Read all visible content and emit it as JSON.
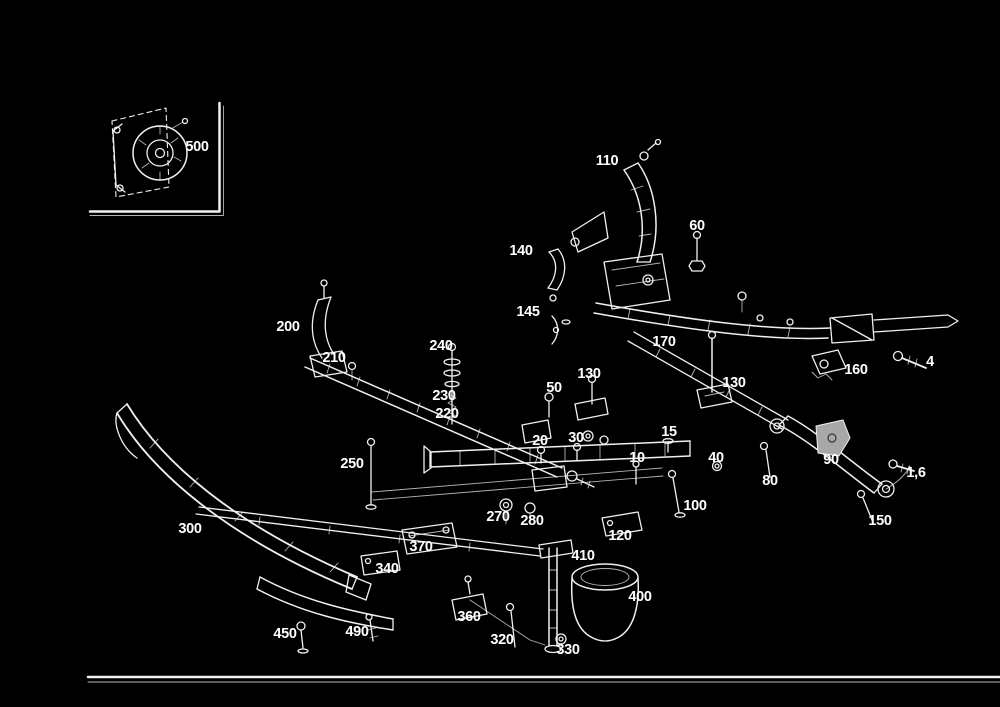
{
  "diagram": {
    "kind": "exploded-parts-diagram",
    "description": "Exploded view line-art diagram of a vehicle front axle / crossmember / bumper assembly with numbered part callouts, white on black",
    "background_color": "#000000",
    "line_color": "#f0f0f0",
    "label_color": "#ffffff",
    "buffer_fill_color": "#a8a8a8",
    "inset": {
      "label": "500"
    },
    "labels": [
      {
        "text": "500",
        "x": 197,
        "y": 147
      },
      {
        "text": "110",
        "x": 607,
        "y": 161
      },
      {
        "text": "60",
        "x": 697,
        "y": 226
      },
      {
        "text": "140",
        "x": 521,
        "y": 251
      },
      {
        "text": "145",
        "x": 528,
        "y": 312
      },
      {
        "text": "200",
        "x": 288,
        "y": 327
      },
      {
        "text": "210",
        "x": 334,
        "y": 358
      },
      {
        "text": "240",
        "x": 441,
        "y": 346
      },
      {
        "text": "230",
        "x": 444,
        "y": 396
      },
      {
        "text": "220",
        "x": 447,
        "y": 414
      },
      {
        "text": "170",
        "x": 664,
        "y": 342
      },
      {
        "text": "130",
        "x": 589,
        "y": 374
      },
      {
        "text": "130",
        "x": 734,
        "y": 383
      },
      {
        "text": "160",
        "x": 856,
        "y": 370
      },
      {
        "text": "4",
        "x": 930,
        "y": 362
      },
      {
        "text": "50",
        "x": 554,
        "y": 388
      },
      {
        "text": "20",
        "x": 540,
        "y": 441
      },
      {
        "text": "30",
        "x": 576,
        "y": 438
      },
      {
        "text": "10",
        "x": 637,
        "y": 458
      },
      {
        "text": "15",
        "x": 669,
        "y": 432
      },
      {
        "text": "40",
        "x": 716,
        "y": 458
      },
      {
        "text": "80",
        "x": 770,
        "y": 481
      },
      {
        "text": "90",
        "x": 831,
        "y": 460
      },
      {
        "text": "1,6",
        "x": 916,
        "y": 473
      },
      {
        "text": "150",
        "x": 880,
        "y": 521
      },
      {
        "text": "100",
        "x": 695,
        "y": 506
      },
      {
        "text": "120",
        "x": 620,
        "y": 536
      },
      {
        "text": "250",
        "x": 352,
        "y": 464
      },
      {
        "text": "270",
        "x": 498,
        "y": 517
      },
      {
        "text": "280",
        "x": 532,
        "y": 521
      },
      {
        "text": "300",
        "x": 190,
        "y": 529
      },
      {
        "text": "370",
        "x": 421,
        "y": 547
      },
      {
        "text": "340",
        "x": 387,
        "y": 569
      },
      {
        "text": "360",
        "x": 469,
        "y": 617
      },
      {
        "text": "450",
        "x": 285,
        "y": 634
      },
      {
        "text": "490",
        "x": 357,
        "y": 632
      },
      {
        "text": "410",
        "x": 583,
        "y": 556
      },
      {
        "text": "400",
        "x": 640,
        "y": 597
      },
      {
        "text": "320",
        "x": 502,
        "y": 640
      },
      {
        "text": "330",
        "x": 568,
        "y": 650
      }
    ]
  }
}
